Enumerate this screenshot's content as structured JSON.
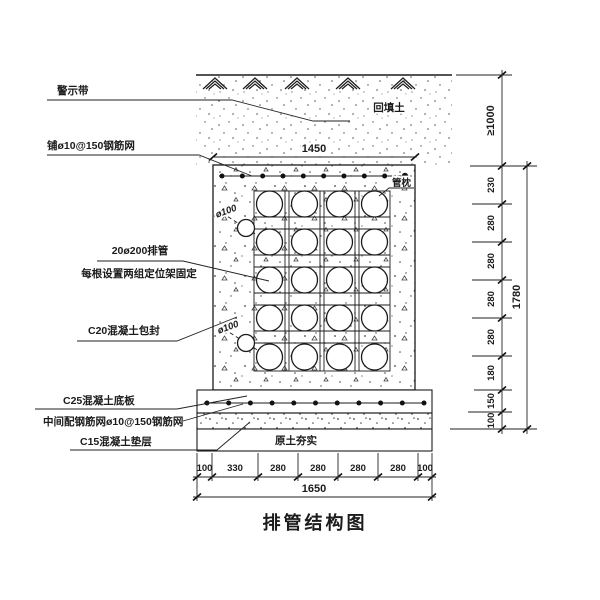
{
  "title": "排管结构图",
  "colors": {
    "ink": "#1b1b1b",
    "paper": "#ffffff"
  },
  "callouts": {
    "warning_tape": "警示带",
    "top_mesh": "铺ø10@150钢筋网",
    "pipes": "20ø200排管",
    "pipe_fixing": "每根设置两组定位架固定",
    "encasement": "C20混凝土包封",
    "base_slab": "C25混凝土底板",
    "slab_mesh": "中间配钢筋网ø10@150钢筋网",
    "cushion": "C15混凝土垫层",
    "fill_soil": "回填土",
    "pipe_pillow": "管枕",
    "drain_top": "ø100",
    "drain_bottom": "ø100",
    "compacted_soil": "原土夯实"
  },
  "dimensions": {
    "top_width": "1450",
    "cover_depth": "≥1000",
    "right_chain": [
      "230",
      "280",
      "280",
      "280",
      "280",
      "180",
      "150",
      "100"
    ],
    "right_total": "1780",
    "bottom_chain": [
      "100",
      "330",
      "280",
      "280",
      "280",
      "280",
      "100"
    ],
    "bottom_total": "1650"
  },
  "structure": {
    "pipe_rows": 5,
    "pipe_cols": 4
  }
}
